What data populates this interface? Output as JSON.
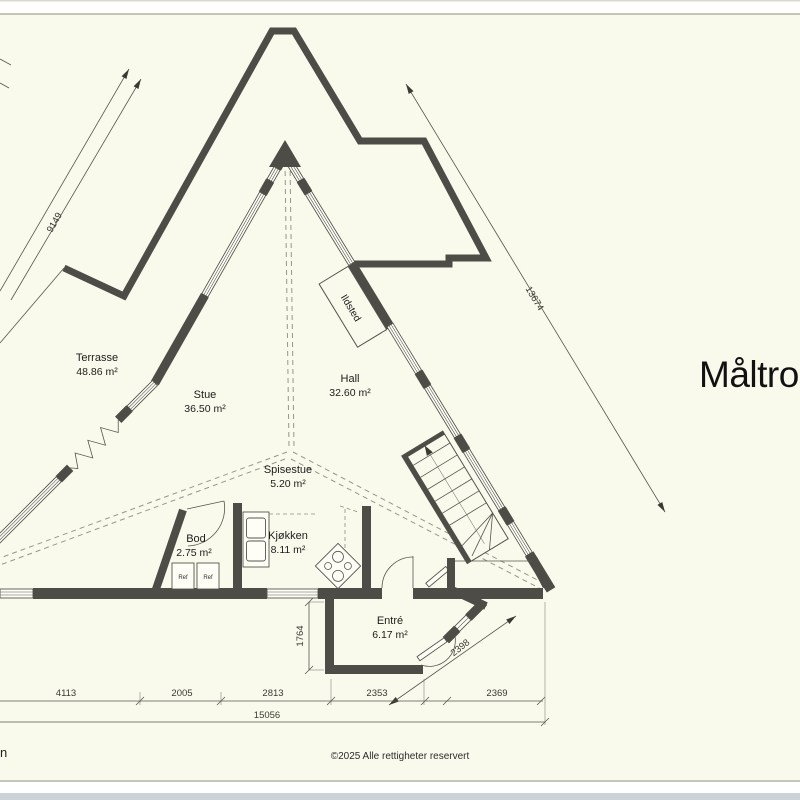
{
  "page": {
    "title": "Måltros",
    "copyright": "©2025 Alle rettigheter reservert",
    "stray_text": "n",
    "background": "#fafaec",
    "wall_color": "#4d4c47"
  },
  "rooms": [
    {
      "name": "Terrasse",
      "area": "48.86 m²"
    },
    {
      "name": "Stue",
      "area": "36.50 m²"
    },
    {
      "name": "Hall",
      "area": "32.60 m²"
    },
    {
      "name": "Spisestue",
      "area": "5.20 m²"
    },
    {
      "name": "Bod",
      "area": "2.75 m²"
    },
    {
      "name": "Kjøkken",
      "area": "8.11 m²"
    },
    {
      "name": "Entré",
      "area": "6.17 m²"
    }
  ],
  "fixtures": {
    "fireplace_label": "Ildsted",
    "fridge1_label": "Ref",
    "fridge2_label": "Ref"
  },
  "dimensions": {
    "left_wall": "9149",
    "right_wall": "13674",
    "bottom_segments": [
      "4113",
      "2005",
      "2813",
      "2353",
      "2369"
    ],
    "bottom_total": "15056",
    "entry_depth": "1764",
    "entry_wall": "2398"
  }
}
